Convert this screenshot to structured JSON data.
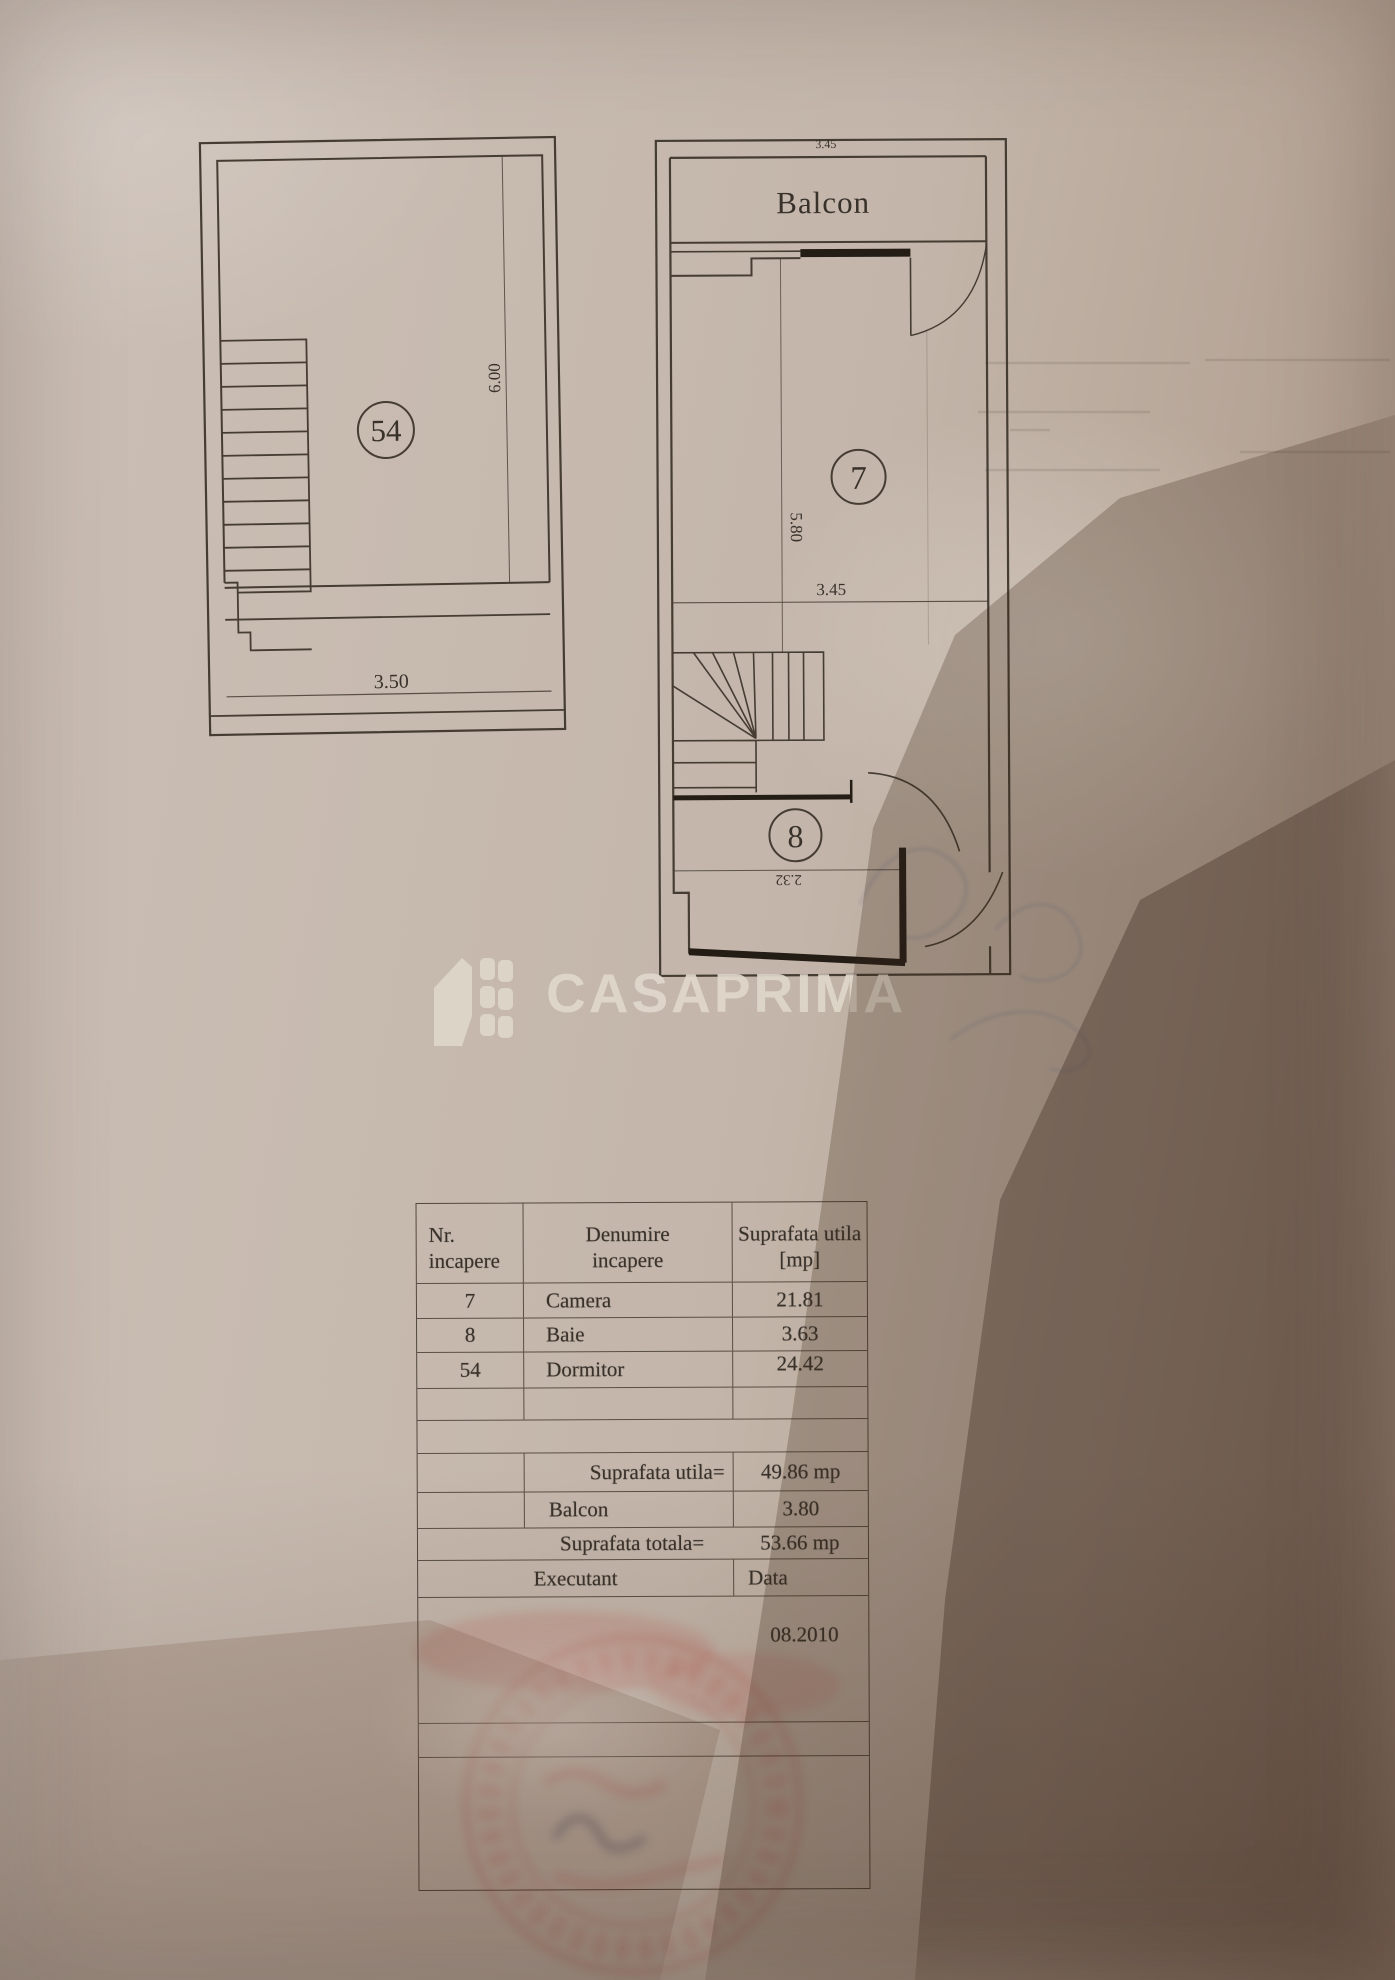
{
  "plans": {
    "upper_floor": {
      "room_number": "54",
      "dim_width": "3.50",
      "dim_height": "6.00"
    },
    "main_floor": {
      "balcony_label": "Balcon",
      "balcony_dim": "3.45",
      "room_camera_number": "7",
      "dim_vertical": "5.80",
      "dim_horizontal": "3.45",
      "room_baie_number": "8",
      "dim_baie": "2.32"
    }
  },
  "watermark": {
    "brand": "CASAPRIMA"
  },
  "table": {
    "header": {
      "col1_line1": "Nr.",
      "col1_line2": "incapere",
      "col2_line1": "Denumire",
      "col2_line2": "incapere",
      "col3_line1": "Suprafata utila",
      "col3_line2": "[mp]"
    },
    "rows": [
      {
        "nr": "7",
        "name": "Camera",
        "area": "21.81"
      },
      {
        "nr": "8",
        "name": "Baie",
        "area": "3.63"
      },
      {
        "nr": "54",
        "name": "Dormitor",
        "area": "24.42"
      }
    ],
    "summary": {
      "utila_label": "Suprafata utila=",
      "utila_value": "49.86 mp",
      "balcon_label": "Balcon",
      "balcon_value": "3.80",
      "totala_label": "Suprafata totala=",
      "totala_value": "53.66 mp"
    },
    "footer": {
      "executant_label": "Executant",
      "data_label": "Data",
      "date_value": "08.2010"
    }
  },
  "colors": {
    "paper": "#c6b9ae",
    "ink": "#3a332b",
    "stamp_red": "#b8493f",
    "watermark": "#ddd4c9"
  }
}
